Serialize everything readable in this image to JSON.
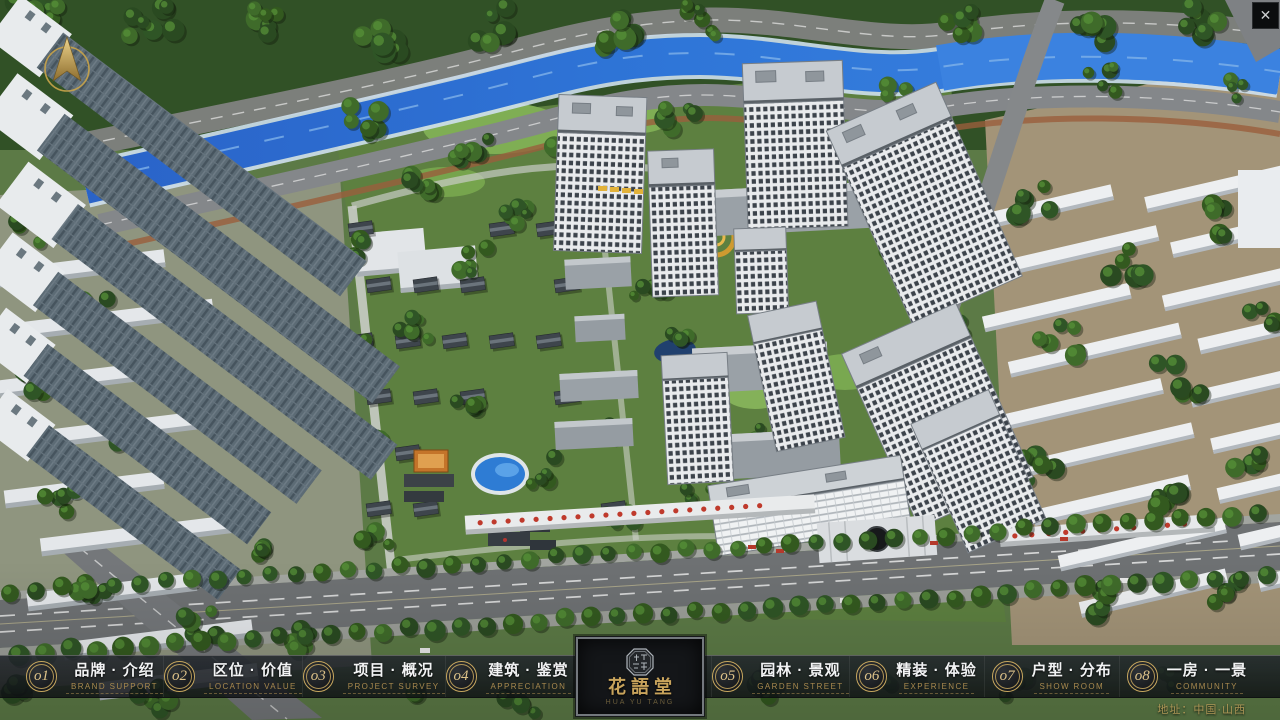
{
  "app": {
    "close_icon": "✕",
    "address": "地址：中国·山西"
  },
  "logo": {
    "title": "花語堂",
    "subtitle": "HUA YU TANG"
  },
  "colors": {
    "gold": "#c9a45c",
    "bar_bg": "#14181c",
    "water": "#2f6fd0"
  },
  "nav": {
    "items": [
      {
        "num": "o1",
        "zh": "品牌 · 介绍",
        "en": "BRAND SUPPORT"
      },
      {
        "num": "o2",
        "zh": "区位 · 价值",
        "en": "LOCATION VALUE"
      },
      {
        "num": "o3",
        "zh": "项目 · 概况",
        "en": "PROJECT SURVEY"
      },
      {
        "num": "o4",
        "zh": "建筑 · 鉴赏",
        "en": "APPRECIATION"
      },
      {
        "num": "o5",
        "zh": "园林 · 景观",
        "en": "GARDEN STREET"
      },
      {
        "num": "o6",
        "zh": "精装 · 体验",
        "en": "EXPERIENCE"
      },
      {
        "num": "o7",
        "zh": "户型 · 分布",
        "en": "SHOW ROOM"
      },
      {
        "num": "o8",
        "zh": "一房 · 一景",
        "en": "COMMUNITY"
      }
    ]
  }
}
